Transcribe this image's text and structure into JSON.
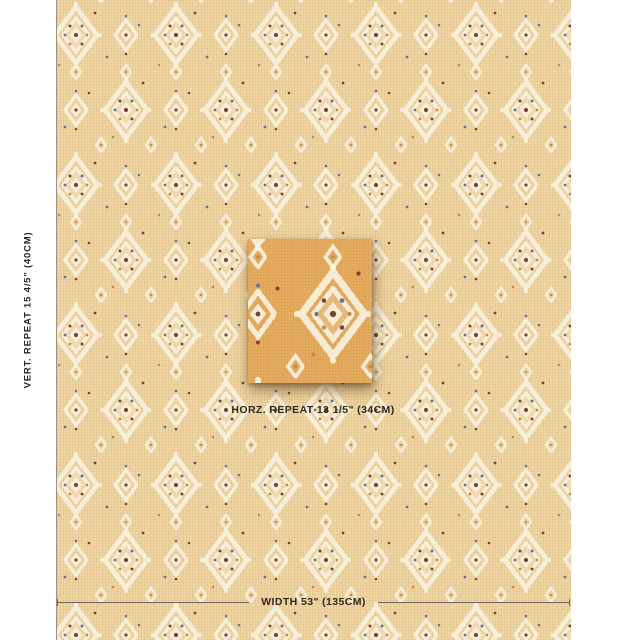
{
  "annotations": {
    "vertical_repeat": "VERT. REPEAT 15 4/5\" (40CM)",
    "horizontal_repeat": "HORZ. REPEAT 13 1/5\" (34CM)",
    "width": "WIDTH 53\" (135CM)"
  },
  "colors": {
    "fabric_ground": "#f1d7a4",
    "swatch_ground": "#e7ad5f",
    "motif_cream": "#f8f1df",
    "dot_rust": "#7b4335",
    "dot_blue": "#66719b",
    "dot_gold": "#c08a4e",
    "label_text": "#2d2822",
    "measure_line": "#6e6860"
  }
}
